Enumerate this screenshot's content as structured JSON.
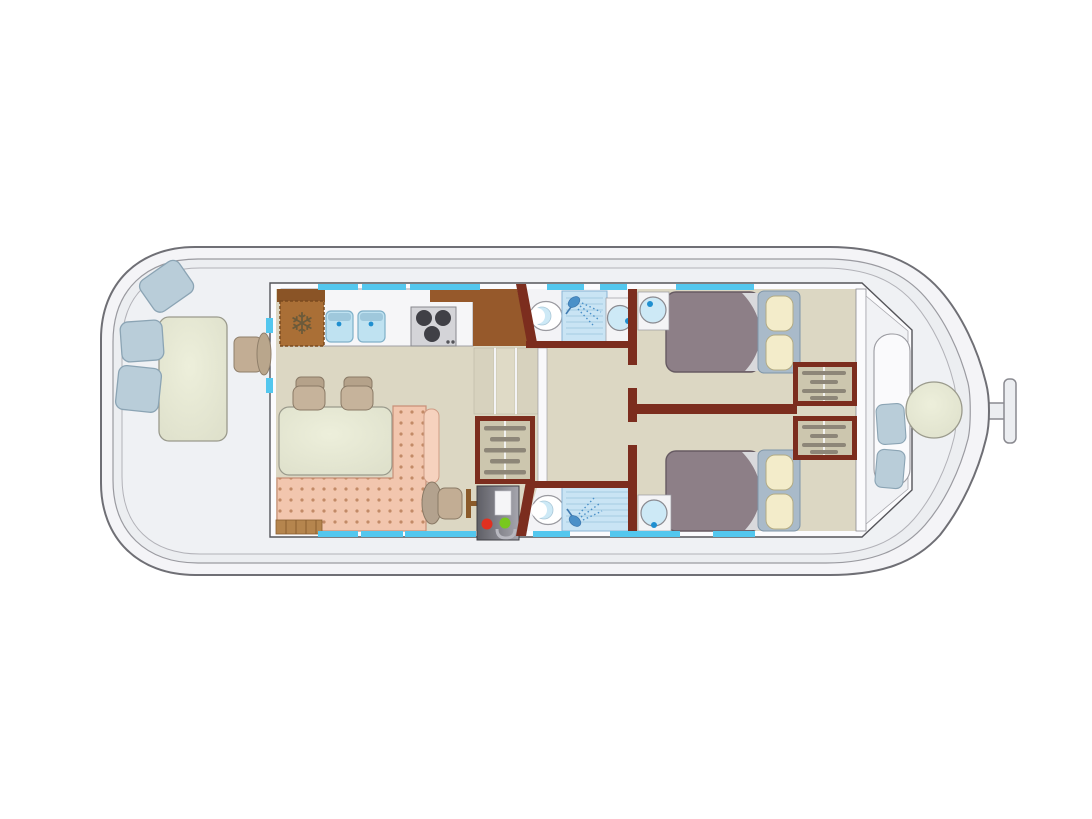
{
  "palette": {
    "hull_fill": "#f4f4f7",
    "hull_stroke": "#6f6f75",
    "deck_fill": "#eceef1",
    "deck_line": "#9a9aa0",
    "wall_white": "#fbfbfd",
    "wall_stroke": "#55555a",
    "wall_maroon": "#7c2d1e",
    "window_cyan": "#53c7ee",
    "floor_beige": "#dcd7c3",
    "bathroom_white": "#f3f3f6",
    "counter_white": "#f6f6f8",
    "counter_brown": "#96592b",
    "fridge_brown": "#aa6f36",
    "sink_blue": "#bfe2f1",
    "stove_gray": "#d4d4d8",
    "burner_black": "#404046",
    "table_green": "#e2e4d0",
    "chair_tan": "#c6b39b",
    "chair_back_tan": "#b5a28a",
    "sofa_pink": "#f2c6ae",
    "sofa_back_pink": "#f6d2be",
    "sofa_dot": "#c28a67",
    "bed_duvet": "#8d7f87",
    "bed_sheet": "#d9d9dc",
    "bed_headboard": "#a9bac9",
    "pillow_cream": "#f3ecca",
    "closet_beige": "#ccc6ae",
    "hanger_gray": "#8d8678",
    "seat_blue": "#b9cdd9",
    "helm_tan": "#c2ad94",
    "shower_blue": "#c9e4f4",
    "shower_icon_blue": "#4a90c8",
    "fixture_blue": "#cde9f6",
    "faucet_blue": "#1f8fd0",
    "panel_red": "#e03020",
    "panel_green": "#78c81e",
    "steps_brown": "#b5854e"
  },
  "icons": {
    "snowflake": "❄"
  }
}
